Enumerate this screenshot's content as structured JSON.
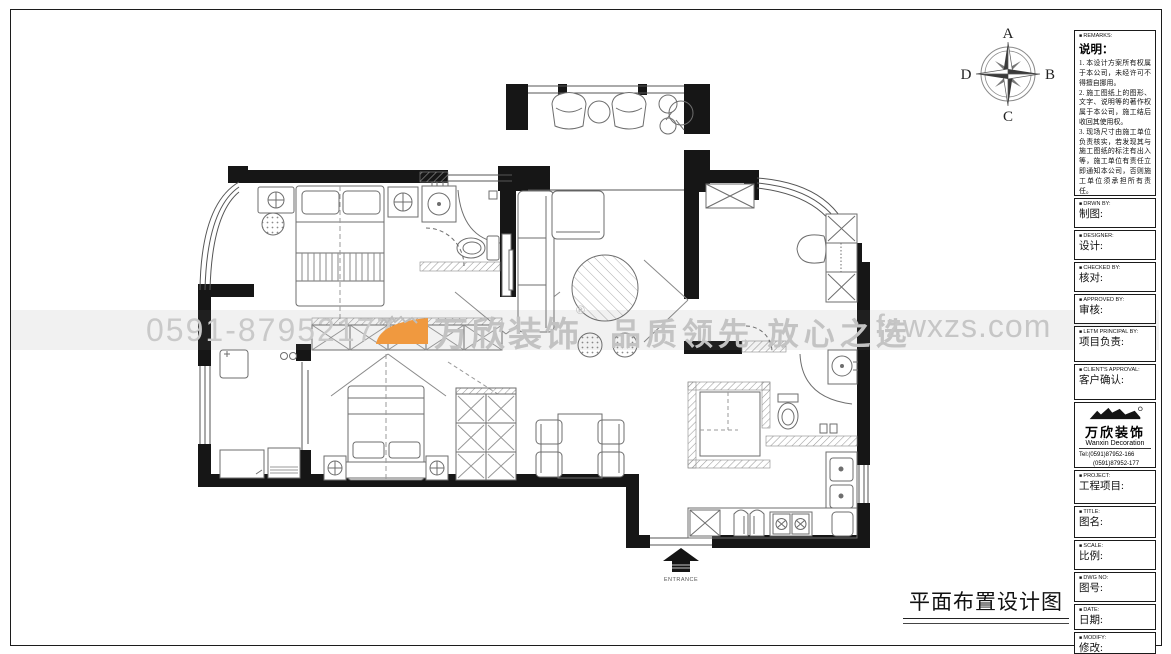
{
  "compass": {
    "top": "A",
    "right": "B",
    "bottom": "C",
    "left": "D"
  },
  "watermark": {
    "phone": "0591-87952177",
    "brand": "万欣装饰",
    "reg": "®",
    "slogan": "品质领先 放心之选",
    "website": "fzwxzs.com",
    "accent_color": "#f0993f",
    "text_color": "#c3c3c3"
  },
  "plan": {
    "entrance_label": "ENTRANCE"
  },
  "title_block": {
    "drawing_title": "平面布置设计图"
  },
  "sidebar": {
    "remarks": {
      "header": "REMARKS:",
      "title": "说明：",
      "items": [
        "1. 本设计方案所有权属于本公司，未经许可不得擅自挪用。",
        "2. 施工图纸上的图形、文字、说明等的著作权属于本公司，施工结后收回其使用权。",
        "3. 现场尺寸由施工单位负责核实，若发现其与施工图纸的标注有出入等，施工单位有责任立即通知本公司，否则施工单位须承担所有责任。",
        "4. 本设计方案是依客户要求设计，经客户签字即视为同意认可，不得随意更改。"
      ]
    },
    "fields": [
      {
        "en": "DRWN BY:",
        "zh": "制图:"
      },
      {
        "en": "DESIGNER:",
        "zh": "设计:"
      },
      {
        "en": "CHECKED BY:",
        "zh": "核对:"
      },
      {
        "en": "APPROVED BY:",
        "zh": "审核:"
      },
      {
        "en": "LETM PRINCIPAL BY:",
        "zh": "项目负责:"
      },
      {
        "en": "CLIENT'S APPROVAL:",
        "zh": "客户确认:"
      }
    ],
    "company": {
      "name_cn": "万欣装饰",
      "name_en": "Wanxin Decoration",
      "tel1": "Tel:(0591)87952-166",
      "tel2": "(0591)87952-177",
      "fax": "Fax:(0591)87952-199",
      "web": "Web:WWW.fzwxzs.com"
    },
    "fields_lower": [
      {
        "en": "PROJECT:",
        "zh": "工程项目:"
      },
      {
        "en": "TITLE:",
        "zh": "图名:"
      },
      {
        "en": "SCALE:",
        "zh": "比例:"
      },
      {
        "en": "DWG NO:",
        "zh": "图号:"
      },
      {
        "en": "DATE:",
        "zh": "日期:"
      },
      {
        "en": "MODIFY:",
        "zh": "修改:"
      }
    ]
  }
}
